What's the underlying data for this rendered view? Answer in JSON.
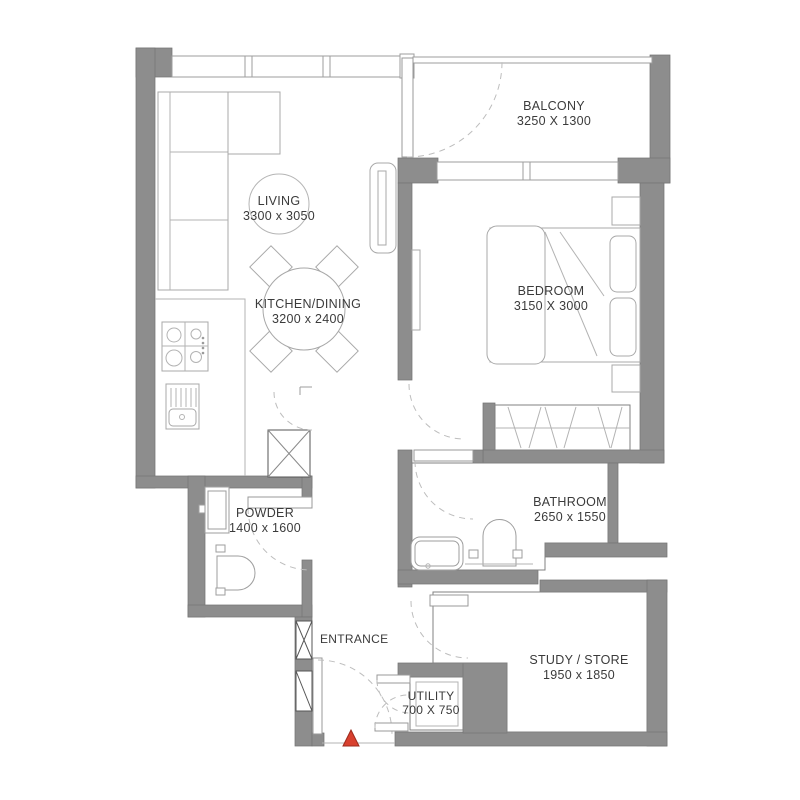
{
  "plan": {
    "rooms": {
      "living": {
        "label": "LIVING",
        "dims": "3300 x 3050"
      },
      "kitchen_dining": {
        "label": "KITCHEN/DINING",
        "dims": "3200 x 2400"
      },
      "balcony": {
        "label": "BALCONY",
        "dims": "3250 X 1300"
      },
      "bedroom": {
        "label": "BEDROOM",
        "dims": "3150 X 3000"
      },
      "powder": {
        "label": "POWDER",
        "dims": "1400 x 1600"
      },
      "bathroom": {
        "label": "BATHROOM",
        "dims": "2650 x 1550"
      },
      "study_store": {
        "label": "STUDY / STORE",
        "dims": "1950 x 1850"
      },
      "utility": {
        "label": "UTILITY",
        "dims": "700 X 750"
      },
      "entrance": {
        "label": "ENTRANCE"
      }
    },
    "colors": {
      "wall": "#8d8d8d",
      "wall_edge": "#757575",
      "furniture_line": "#a8a8a8",
      "door_arc": "#bdbdbd",
      "text": "#3b3b3b",
      "entrance_marker_fill": "#d8402e",
      "entrance_marker_edge": "#9c2a1c"
    }
  }
}
